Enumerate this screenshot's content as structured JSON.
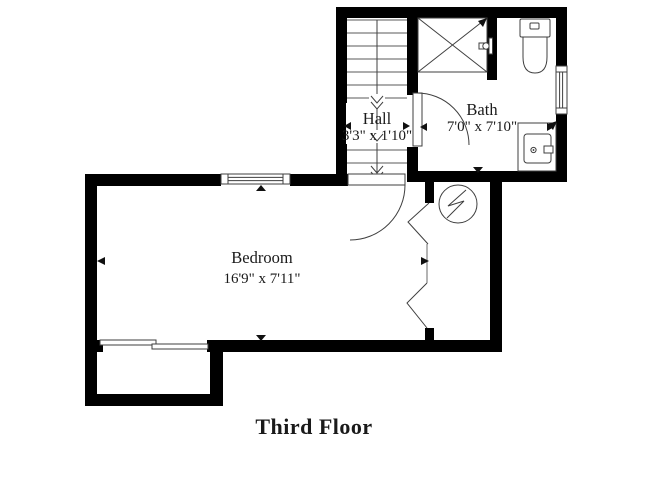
{
  "plan": {
    "title": "Third Floor",
    "rooms": {
      "hall": {
        "name": "Hall",
        "size": "3'3\" x 1'10\""
      },
      "bath": {
        "name": "Bath",
        "size": "7'0\" x 7'10\""
      },
      "bedroom": {
        "name": "Bedroom",
        "size": "16'9\" x 7'11\""
      }
    },
    "fixtures": [
      "staircase-down-arrow",
      "shower-stall",
      "shower-valve",
      "toilet",
      "sink-vanity",
      "window",
      "swing-door",
      "bifold-closet-doors",
      "sliding-door",
      "light-fixture-symbol"
    ],
    "colors": {
      "wall": "#000000",
      "line": "#3f3f3f",
      "text": "#1a1a1a",
      "background": "#ffffff"
    }
  }
}
